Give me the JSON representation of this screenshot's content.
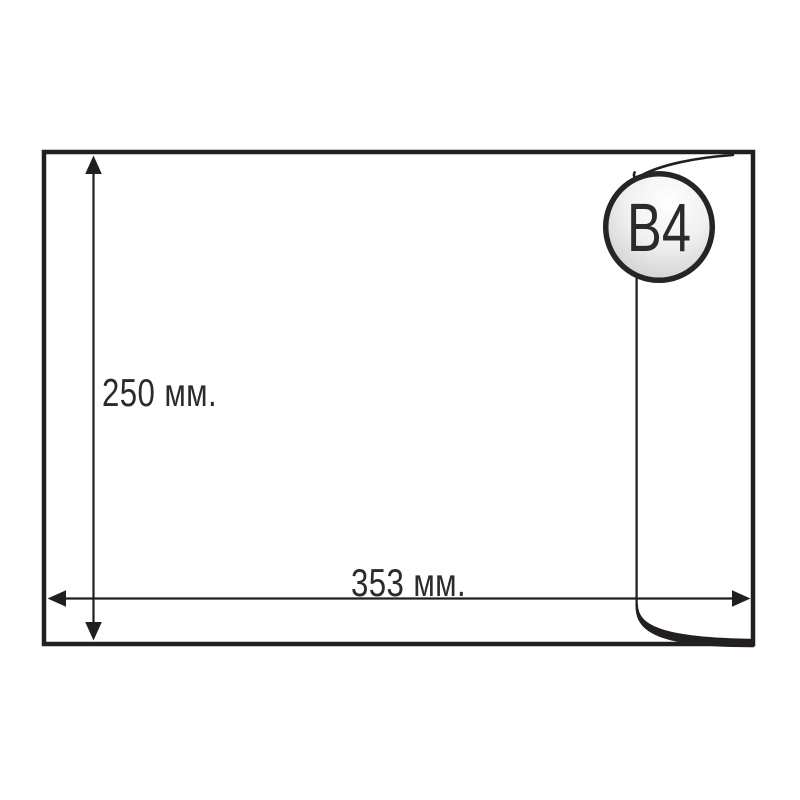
{
  "diagram": {
    "type": "envelope-dimension-diagram",
    "size_badge_label": "B4",
    "height_label": "250 мм.",
    "width_label": "353 мм.",
    "height_mm": 250,
    "width_mm": 353,
    "ink_color": "#231f20",
    "text_color": "#2b2b2b",
    "badge_stroke_color": "#282425",
    "badge_gradient_light": "#ffffff",
    "badge_gradient_dark": "#c6c6c6",
    "background_color": "#ffffff"
  }
}
